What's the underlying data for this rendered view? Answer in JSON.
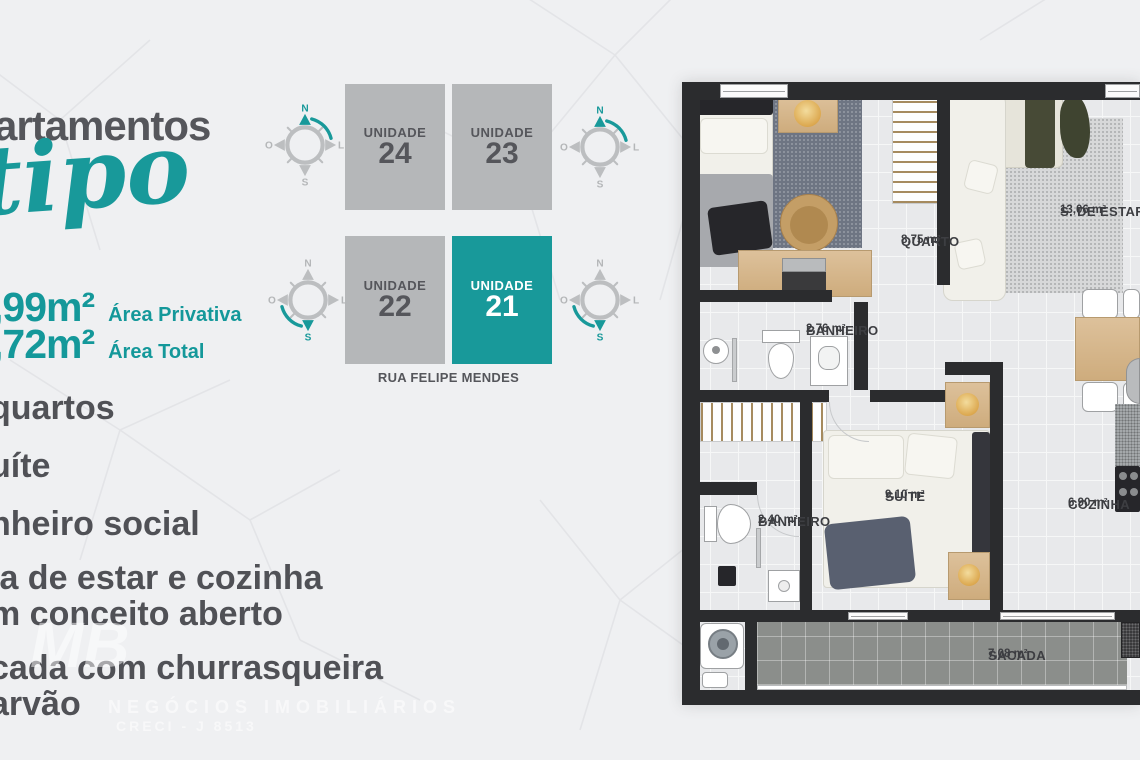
{
  "page": {
    "background_color": "#eff0f2",
    "accent_color": "#18999a",
    "text_color": "#55565b"
  },
  "left_panel": {
    "title_fragment": "artamentos",
    "title_script": "tipo",
    "areas": [
      {
        "value": ",99m²",
        "label": "Área Privativa"
      },
      {
        "value": ",72m²",
        "label": "Área Total"
      }
    ],
    "features": [
      "quartos",
      "uíte",
      "nheiro social",
      "la de estar e cozinha",
      "m conceito aberto",
      "cada com churrasqueira",
      "arvão"
    ]
  },
  "unit_diagram": {
    "street_label": "RUA FELIPE MENDES",
    "units": [
      {
        "label": "UNIDADE",
        "number": "24",
        "highlighted": false
      },
      {
        "label": "UNIDADE",
        "number": "23",
        "highlighted": false
      },
      {
        "label": "UNIDADE",
        "number": "22",
        "highlighted": false
      },
      {
        "label": "UNIDADE",
        "number": "21",
        "highlighted": true
      }
    ],
    "compass": {
      "north": "N",
      "east": "L",
      "south": "S",
      "west": "O"
    }
  },
  "floor_plan": {
    "rooms": [
      {
        "name": "QUARTO",
        "area": "8,75 m²"
      },
      {
        "name": "S. DE ESTAR",
        "area": "13,06 m²"
      },
      {
        "name": "BANHEIRO",
        "area": "2,76 m²"
      },
      {
        "name": "SUÍTE",
        "area": "9,10 m²"
      },
      {
        "name": "BANHEIRO",
        "area": "2,40 m²"
      },
      {
        "name": "COZINHA",
        "area": "6,90 m²"
      },
      {
        "name": "SACADA",
        "area": "7,08 m²"
      }
    ]
  },
  "watermark": {
    "monogram": "MB",
    "line1": "NEGÓCIOS IMOBILIÁRIOS",
    "line2": "CRECI - J 8513"
  }
}
